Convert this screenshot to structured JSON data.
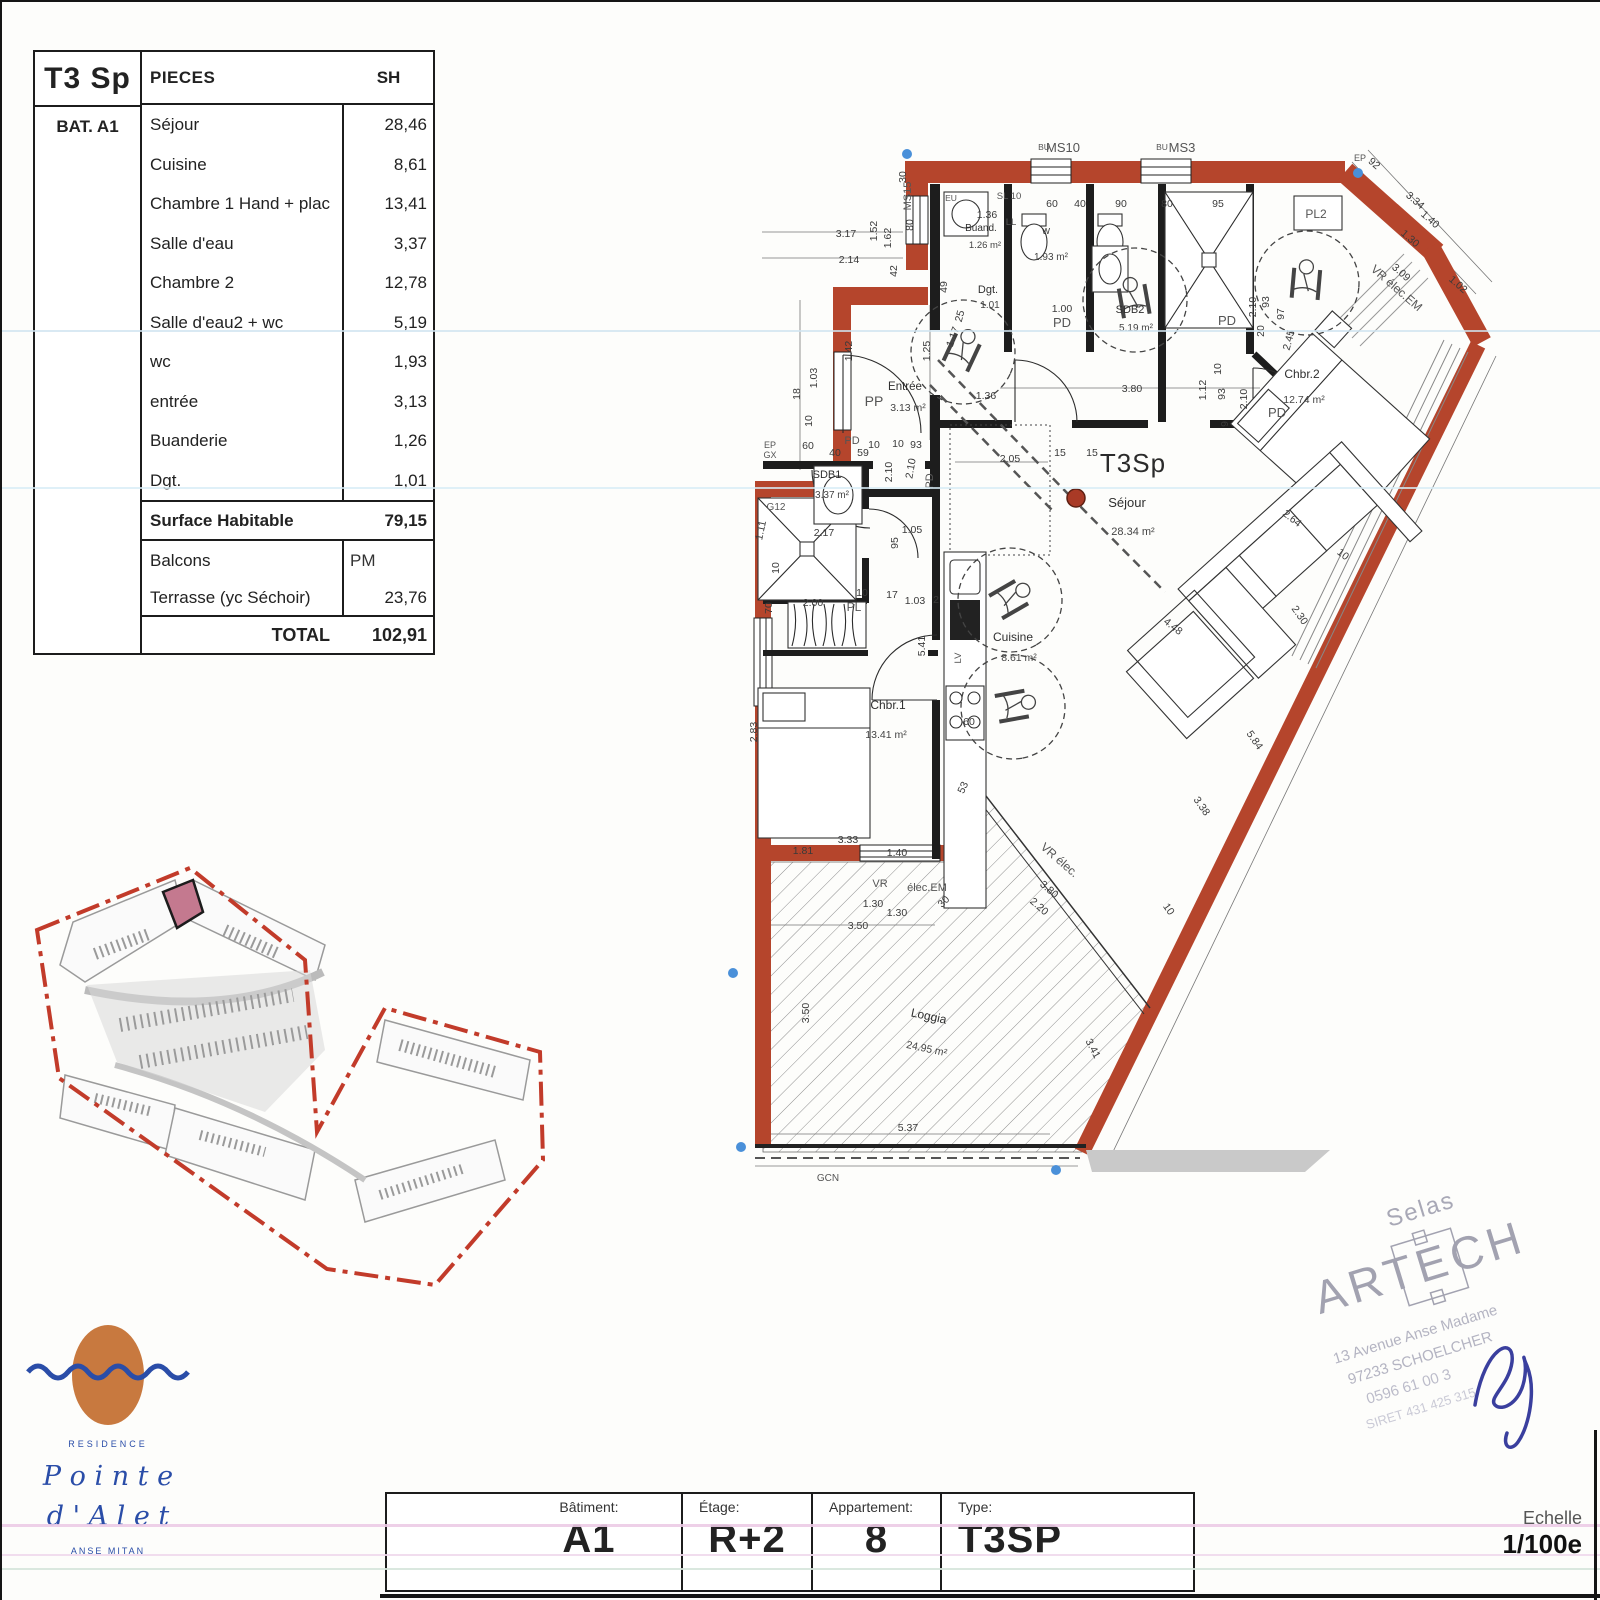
{
  "page": {
    "scale_label": "Echelle",
    "scale_value": "1/100e"
  },
  "table": {
    "type_label": "T3 Sp",
    "header_pieces": "PIECES",
    "header_sh": "SH",
    "building": "BAT. A1",
    "rows": [
      {
        "label": "Séjour",
        "value": "28,46"
      },
      {
        "label": "Cuisine",
        "value": "8,61"
      },
      {
        "label": "Chambre 1 Hand + plac",
        "value": "13,41"
      },
      {
        "label": "Salle d'eau",
        "value": "3,37"
      },
      {
        "label": "Chambre 2",
        "value": "12,78"
      },
      {
        "label": "Salle d'eau2 + wc",
        "value": "5,19"
      },
      {
        "label": "wc",
        "value": "1,93"
      },
      {
        "label": "entrée",
        "value": "3,13"
      },
      {
        "label": "Buanderie",
        "value": "1,26"
      },
      {
        "label": "Dgt.",
        "value": "1,01"
      }
    ],
    "surface_row": {
      "label": "Surface Habitable",
      "value": "79,15"
    },
    "balcons_row": {
      "label": "Balcons",
      "value": "PM"
    },
    "terrasse_row": {
      "label": "Terrasse (yc Séchoir)",
      "value": "23,76"
    },
    "total_row": {
      "label": "TOTAL",
      "value": "102,91"
    }
  },
  "title_block": {
    "cells": [
      {
        "label": "Bâtiment:",
        "value": "A1"
      },
      {
        "label": "Étage:",
        "value": "R+2"
      },
      {
        "label": "Appartement:",
        "value": "8"
      },
      {
        "label": "Type:",
        "value": "T3SP"
      }
    ]
  },
  "logo": {
    "residence": "RESIDENCE",
    "name1": "P o i n t e",
    "name2": "d ' A l e t",
    "place": "ANSE MITAN",
    "orange": "#c8793f",
    "blue": "#2a4da8"
  },
  "stamp": {
    "line0": "Selas",
    "name": "ARTECH",
    "addr1": "13 Avenue Anse Madame",
    "addr2": "97233 SCHOELCHER",
    "addr3": "0596 61 00 3",
    "addr4": "SIRET 431 425 315"
  },
  "plan": {
    "unit_label": "T3Sp",
    "wall_color": "#b5452c",
    "site_boundary_color": "#c23b2a",
    "site_highlight_color": "#c4798f",
    "rooms": [
      {
        "name": "Séjour",
        "area": "28.34 m²",
        "nx": 1127,
        "ny": 507,
        "ax": 1133,
        "ay": 535,
        "ns": 13,
        "as": 11,
        "r": 0
      },
      {
        "name": "Cuisine",
        "area": "8.61 m²",
        "nx": 1013,
        "ny": 641,
        "ax": 1019,
        "ay": 661,
        "ns": 12,
        "as": 10.5,
        "r": 0
      },
      {
        "name": "Chbr.1",
        "area": "13.41 m²",
        "nx": 888,
        "ny": 709,
        "ax": 886,
        "ay": 738,
        "ns": 12,
        "as": 10.5,
        "r": 0
      },
      {
        "name": "Chbr.2",
        "area": "12.74 m²",
        "nx": 1302,
        "ny": 378,
        "ax": 1304,
        "ay": 403,
        "ns": 12,
        "as": 10.5,
        "r": 0
      },
      {
        "name": "SDB1",
        "area": "3.37 m²",
        "nx": 827,
        "ny": 478,
        "ax": 832,
        "ay": 498,
        "ns": 11,
        "as": 10,
        "r": 0
      },
      {
        "name": "SDB2",
        "area": "5.19 m²",
        "nx": 1130,
        "ny": 313,
        "ax": 1136,
        "ay": 331,
        "ns": 11,
        "as": 10,
        "r": 0
      },
      {
        "name": "Entrée",
        "area": "3.13 m²",
        "nx": 905,
        "ny": 390,
        "ax": 908,
        "ay": 411,
        "ns": 11.5,
        "as": 10.5,
        "r": 0
      },
      {
        "name": "Dgt.",
        "area": "1.01",
        "nx": 988,
        "ny": 293,
        "ax": 990,
        "ay": 308,
        "ns": 11,
        "as": 10,
        "r": 0
      },
      {
        "name": "Buand.",
        "area": "1.26 m²",
        "nx": 981,
        "ny": 231,
        "ax": 985,
        "ay": 248,
        "ns": 10,
        "as": 9.5,
        "r": 0
      },
      {
        "name": "W",
        "area": "1.93 m²",
        "nx": 1046,
        "ny": 234,
        "ax": 1051,
        "ay": 260,
        "ns": 8.5,
        "as": 10,
        "r": 0
      },
      {
        "name": "Loggia",
        "area": "24.95 m²",
        "nx": 928,
        "ny": 1020,
        "ax": 926,
        "ay": 1052,
        "ns": 12,
        "as": 10.5,
        "r": 12
      }
    ],
    "tags": [
      [
        "MS10",
        1063,
        152,
        0,
        13,
        "#333"
      ],
      [
        "MS3",
        1182,
        152,
        0,
        13,
        "#333"
      ],
      [
        "BU",
        1044,
        150,
        0,
        8.5,
        "#555"
      ],
      [
        "BU",
        1162,
        150,
        0,
        8.5,
        "#555"
      ],
      [
        "MS15",
        911,
        196,
        -90,
        11,
        "#444"
      ],
      [
        "EU",
        951,
        201,
        0,
        8.5,
        "#555"
      ],
      [
        "SL 10",
        1009,
        199,
        0,
        9.5,
        "#555"
      ],
      [
        "LL",
        1011,
        225,
        0,
        9.5,
        "#555"
      ],
      [
        "PP",
        874,
        406,
        0,
        14,
        "#444"
      ],
      [
        "PD",
        1062,
        327,
        0,
        13,
        "#444"
      ],
      [
        "PD",
        852,
        444,
        0,
        11,
        "#444"
      ],
      [
        "PD",
        933,
        481,
        -90,
        11,
        "#444"
      ],
      [
        "PD",
        1227,
        325,
        0,
        13,
        "#444"
      ],
      [
        "PD",
        1277,
        417,
        0,
        13,
        "#444"
      ],
      [
        "PL",
        854,
        611,
        0,
        12,
        "#444"
      ],
      [
        "PL2",
        1316,
        218,
        0,
        12,
        "#444"
      ],
      [
        "EP",
        1360,
        161,
        0,
        9,
        "#555"
      ],
      [
        "EP",
        770,
        448,
        0,
        9,
        "#555"
      ],
      [
        "GX",
        770,
        458,
        0,
        9,
        "#555"
      ],
      [
        "G12",
        776,
        510,
        0,
        10,
        "#555"
      ],
      [
        "LV",
        961,
        658,
        -90,
        9.5,
        "#555"
      ],
      [
        "VR élec.EM",
        1394,
        291,
        41,
        12,
        "#444"
      ],
      [
        "VR élec.",
        1057,
        863,
        41,
        12,
        "#444"
      ],
      [
        "VR",
        880,
        887,
        0,
        11,
        "#444"
      ],
      [
        "élec.EM",
        927,
        891,
        0,
        11,
        "#444"
      ],
      [
        "GCN",
        828,
        1181,
        0,
        10,
        "#777"
      ]
    ],
    "dims": [
      [
        "3.17",
        846,
        237,
        0
      ],
      [
        "2.14",
        849,
        263,
        0
      ],
      [
        "1.52",
        877,
        231,
        -90
      ],
      [
        "1.62",
        891,
        238,
        -90
      ],
      [
        "42",
        897,
        271,
        -90
      ],
      [
        "30",
        906,
        177,
        -90
      ],
      [
        "80",
        913,
        225,
        -90
      ],
      [
        "60",
        1052,
        207,
        0
      ],
      [
        "40",
        1080,
        207,
        0
      ],
      [
        "90",
        1121,
        207,
        0
      ],
      [
        "80",
        1167,
        207,
        0
      ],
      [
        "95",
        1218,
        207,
        0
      ],
      [
        "1.36",
        987,
        218,
        0
      ],
      [
        "18",
        800,
        394,
        -90
      ],
      [
        "1.03",
        817,
        378,
        -90
      ],
      [
        "10",
        812,
        421,
        -90
      ],
      [
        "1.42",
        852,
        351,
        -90
      ],
      [
        "1.25",
        930,
        351,
        -90
      ],
      [
        "49",
        947,
        287,
        -90
      ],
      [
        "25",
        963,
        317,
        -75
      ],
      [
        "1.17",
        956,
        338,
        -70
      ],
      [
        "1.36",
        986,
        399,
        0
      ],
      [
        "1.00",
        1062,
        312,
        0
      ],
      [
        "2.10",
        1256,
        307,
        -90
      ],
      [
        "93",
        1269,
        302,
        -90
      ],
      [
        "20",
        1264,
        331,
        -90
      ],
      [
        "97",
        1284,
        314,
        -90
      ],
      [
        "2.45",
        1292,
        341,
        -75
      ],
      [
        "2.10",
        1247,
        399,
        -90
      ],
      [
        "1.12",
        1206,
        390,
        -90
      ],
      [
        "93",
        1225,
        394,
        -90
      ],
      [
        "9",
        1228,
        424,
        -90
      ],
      [
        "10",
        1221,
        369,
        -90
      ],
      [
        "3.80",
        1132,
        392,
        0
      ],
      [
        "2.05",
        1010,
        462,
        0
      ],
      [
        "15",
        1060,
        456,
        0
      ],
      [
        "15",
        1092,
        456,
        0
      ],
      [
        "92",
        1372,
        166,
        41
      ],
      [
        "3.34",
        1413,
        203,
        41
      ],
      [
        "1.40",
        1428,
        222,
        41
      ],
      [
        "1.30",
        1408,
        241,
        41
      ],
      [
        "3.09",
        1399,
        275,
        41
      ],
      [
        "1.02",
        1456,
        287,
        41
      ],
      [
        "2.64",
        1290,
        521,
        38
      ],
      [
        "10",
        1341,
        557,
        38
      ],
      [
        "2.30",
        1297,
        617,
        55
      ],
      [
        "4.48",
        1171,
        629,
        38
      ],
      [
        "5.84",
        1252,
        742,
        55
      ],
      [
        "3.38",
        1199,
        808,
        55
      ],
      [
        "10",
        1166,
        911,
        55
      ],
      [
        "60",
        808,
        449,
        0
      ],
      [
        "40",
        835,
        456,
        0
      ],
      [
        "59",
        863,
        456,
        0
      ],
      [
        "10",
        874,
        448,
        0
      ],
      [
        "10",
        898,
        447,
        0
      ],
      [
        "93",
        916,
        448,
        0
      ],
      [
        "2.10",
        892,
        472,
        -90
      ],
      [
        "2.10",
        914,
        469,
        -80
      ],
      [
        "2.17",
        824,
        536,
        0
      ],
      [
        "1.11",
        764,
        531,
        -78
      ],
      [
        "10",
        779,
        568,
        -90
      ],
      [
        "70",
        772,
        608,
        -90
      ],
      [
        "2.00",
        813,
        606,
        0
      ],
      [
        "10",
        862,
        596,
        0
      ],
      [
        "17",
        892,
        598,
        0
      ],
      [
        "1.03",
        915,
        604,
        0
      ],
      [
        "2",
        936,
        603,
        0
      ],
      [
        "95",
        898,
        543,
        -90
      ],
      [
        "1.05",
        912,
        533,
        0
      ],
      [
        "5.41",
        925,
        646,
        -90
      ],
      [
        "2.83",
        757,
        732,
        -90
      ],
      [
        "60",
        969,
        725,
        0
      ],
      [
        "53",
        966,
        789,
        -65
      ],
      [
        "3.33",
        848,
        843,
        0
      ],
      [
        "1.81",
        803,
        854,
        0
      ],
      [
        "1.40",
        897,
        856,
        0
      ],
      [
        "1.30",
        873,
        907,
        0
      ],
      [
        "30",
        946,
        904,
        -45
      ],
      [
        "1.30",
        897,
        916,
        0
      ],
      [
        "3.50",
        858,
        929,
        0
      ],
      [
        "3.50",
        809,
        1013,
        -90
      ],
      [
        "5.37",
        908,
        1131,
        0
      ],
      [
        "3.41",
        1090,
        1050,
        62
      ],
      [
        "3.80",
        1047,
        892,
        41
      ],
      [
        "2.20",
        1037,
        909,
        41
      ]
    ]
  }
}
